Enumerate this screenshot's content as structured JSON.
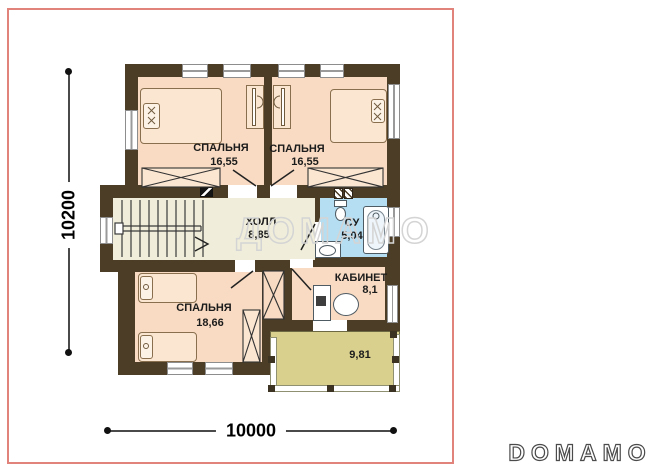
{
  "branding": {
    "watermark": "ДОМАМО",
    "logo": "DOMAMO"
  },
  "dimensions": {
    "height_label": "10200",
    "width_label": "10000"
  },
  "rooms": {
    "bedroom_tl": {
      "name": "СПАЛЬНЯ",
      "area": "16,55"
    },
    "bedroom_tr": {
      "name": "СПАЛЬНЯ",
      "area": "16,55"
    },
    "hall": {
      "name": "ХОЛЛ",
      "area": "8,85"
    },
    "bathroom": {
      "name": "СУ",
      "area": "5,04"
    },
    "office": {
      "name": "КАБИНЕТ",
      "area": "8,1"
    },
    "bedroom_bl": {
      "name": "СПАЛЬНЯ",
      "area": "18,66"
    },
    "balcony": {
      "area": "9,81"
    }
  },
  "colors": {
    "wall": "#4c3d26",
    "bedroom_floor": "#f8dbc2",
    "hall_floor": "#f0eedb",
    "bathroom_floor": "#b5def2",
    "balcony_floor": "#d8d08c",
    "frame": "#e2837b"
  }
}
